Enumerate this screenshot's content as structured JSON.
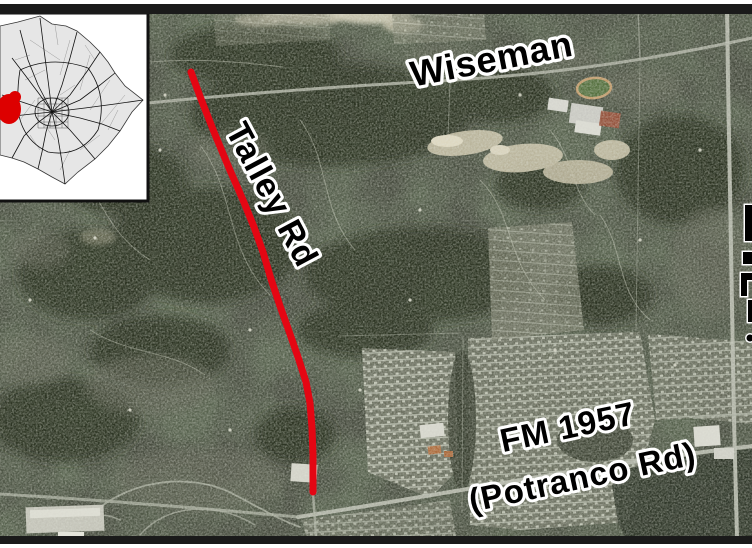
{
  "map": {
    "labels": {
      "wiseman": "Wiseman",
      "talley_rd": "Talley Rd",
      "fm_1957_line1": "FM 1957",
      "fm_1957_line2": "(Potranco Rd)"
    },
    "route": {
      "name": "Talley Rd",
      "color": "#e40613",
      "points": "191,72 201,99 214,132 229,168 243,200 254,227 263,252 271,279 280,306 290,334 299,360 306,382 310,403 312,428 313,455 313,492"
    },
    "inset": {
      "marker_color": "#dd0000"
    },
    "label_text_color": "#000000",
    "label_outline_color": "#ffffff"
  }
}
